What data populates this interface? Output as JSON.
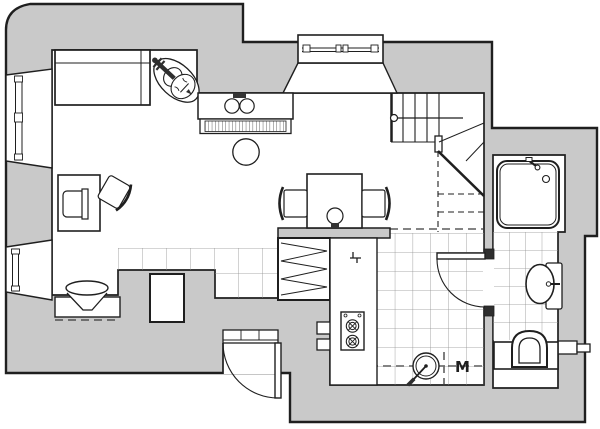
{
  "canvas": {
    "width": 600,
    "height": 429
  },
  "colors": {
    "wall": "#c9c9c9",
    "line": "#1f1f1f",
    "tile": "#8f8f8f",
    "dash": "#3a3a3a",
    "paper": "#ffffff",
    "dark_fill": "#2e2e2e"
  },
  "symbols": {
    "m_mark": "M"
  }
}
